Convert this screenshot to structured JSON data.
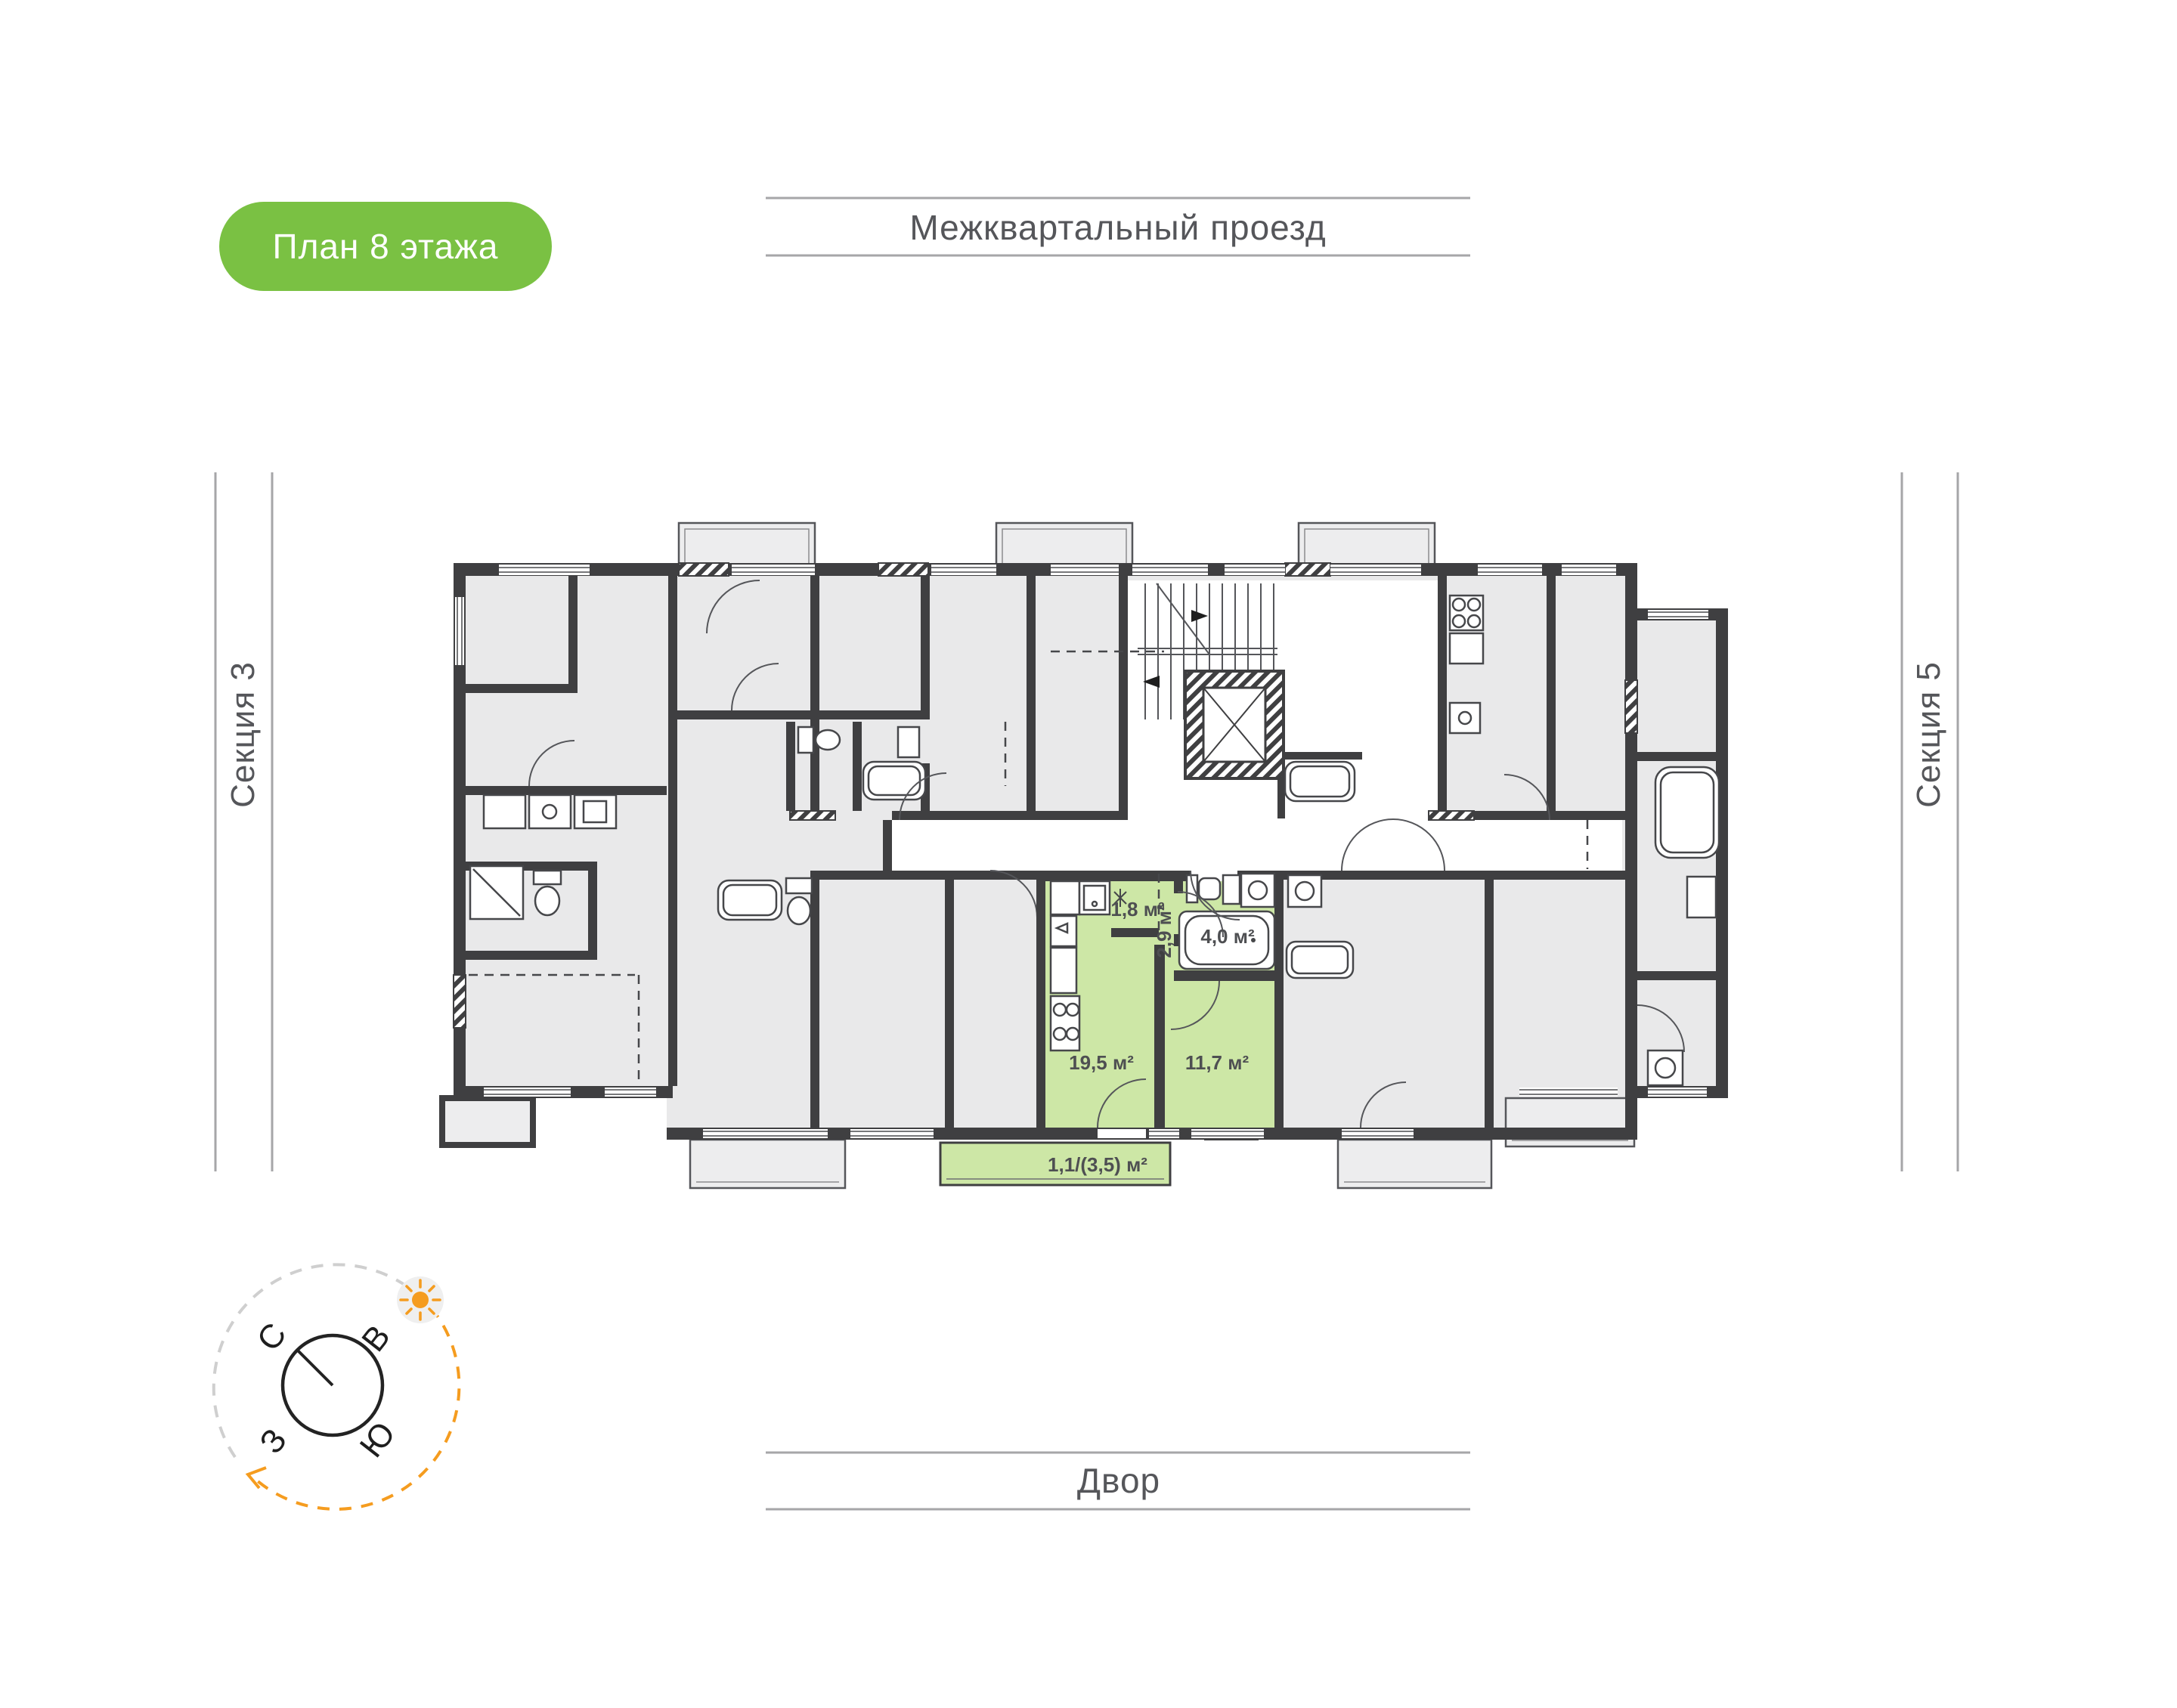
{
  "badge": {
    "label": "План 8 этажа",
    "bg": "#7AC143"
  },
  "surroundings": {
    "top": "Межквартальный проезд",
    "bottom": "Двор",
    "left": "Секция 3",
    "right": "Секция 5"
  },
  "compass": {
    "north": "С",
    "east": "В",
    "west": "З",
    "south": "Ю"
  },
  "apartment": {
    "highlight_color": "#CDE7A6",
    "rooms": {
      "hallway": "1,8 м²",
      "corridor": "2,9 м²",
      "bathroom": "4,0 м²",
      "living": "19,5 м²",
      "bedroom": "11,7 м²",
      "balcony": "1,1/(3,5) м²"
    }
  },
  "colors": {
    "wall": "#3F3F41",
    "room_gray": "#E9E9EA",
    "balcony_gray": "#EDEDEE",
    "guide_line": "#A6A6A8",
    "label_text": "#55565A",
    "compass_orange": "#F59C1F",
    "badge_green": "#7AC143"
  }
}
